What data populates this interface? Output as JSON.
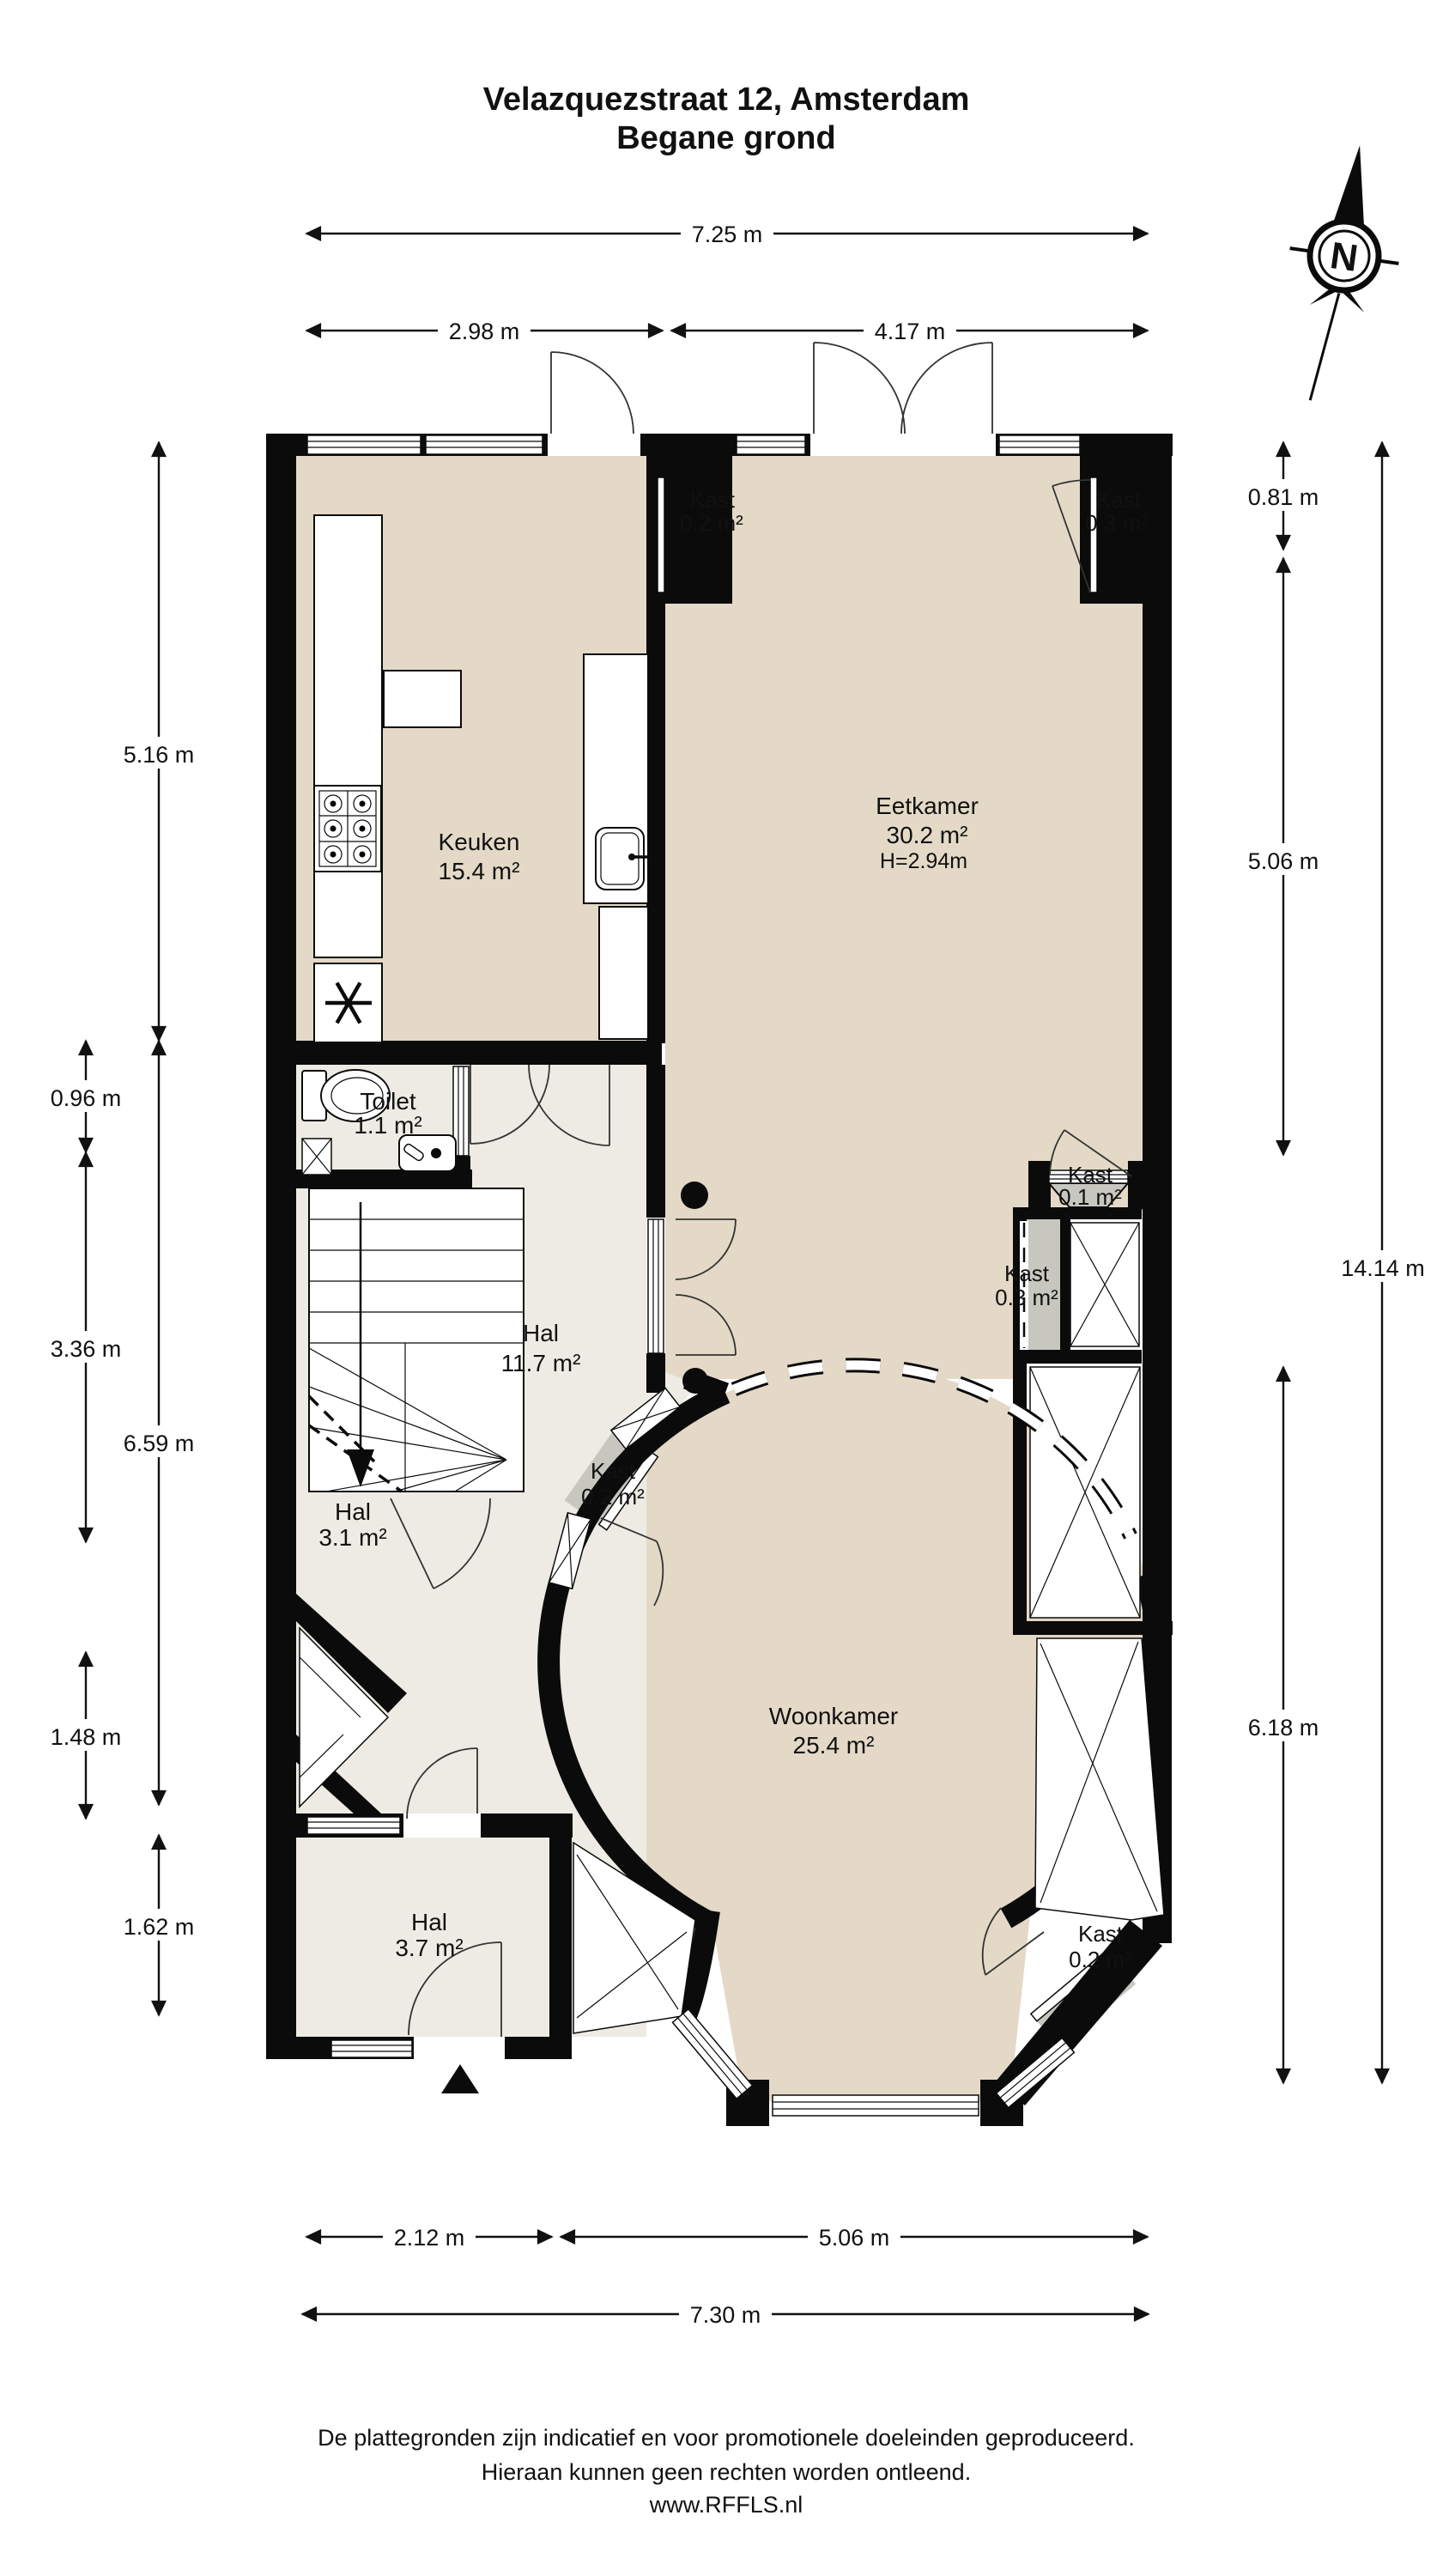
{
  "title": {
    "line1": "Velazquezstraat 12, Amsterdam",
    "line2": "Begane grond"
  },
  "compass": {
    "label": "N"
  },
  "labels": {
    "keuken": {
      "name": "Keuken",
      "area": "15.4 m²"
    },
    "eetkamer": {
      "name": "Eetkamer",
      "area": "30.2 m²",
      "height": "H=2.94m"
    },
    "woonkamer": {
      "name": "Woonkamer",
      "area": "25.4 m²"
    },
    "toilet": {
      "name": "Toilet",
      "area": "1.1 m²"
    },
    "hal_groot": {
      "name": "Hal",
      "area": "11.7 m²"
    },
    "hal_midden": {
      "name": "Hal",
      "area": "3.1 m²"
    },
    "hal_entree": {
      "name": "Hal",
      "area": "3.7 m²"
    },
    "kast_keuken": {
      "name": "Kast",
      "area": "0.2 m²"
    },
    "kast_eetkamer": {
      "name": "Kast",
      "area": "0.3 m²"
    },
    "kast_klein": {
      "name": "Kast",
      "area": "0.1 m²"
    },
    "kast_rechts": {
      "name": "Kast",
      "area": "0.3 m²"
    },
    "kast_rond": {
      "name": "Kast",
      "area": "0.2 m²"
    },
    "kast_erker": {
      "name": "Kast",
      "area": "0.2 m²"
    }
  },
  "dimensions": {
    "top_total": "7.25 m",
    "top_left": "2.98 m",
    "top_right": "4.17 m",
    "left_outer_upper": "5.16 m",
    "left_outer_lower": "6.59 m",
    "left_inner_1": "0.96 m",
    "left_inner_2": "3.36 m",
    "left_inner_3": "1.48 m",
    "left_inner_4": "1.62 m",
    "right_inner_1": "0.81 m",
    "right_inner_2": "5.06 m",
    "right_inner_3": "6.18 m",
    "right_outer": "14.14 m",
    "bottom_left": "2.12 m",
    "bottom_right": "5.06 m",
    "bottom_total": "7.30 m"
  },
  "footer": {
    "line1": "De plattegronden zijn indicatief en voor promotionele doeleinden geproduceerd.",
    "line2": "Hieraan kunnen geen rechten worden ontleend.",
    "line3": "www.RFFLS.nl"
  },
  "colors": {
    "room_beige": "#e3d9c6",
    "hall_light": "#edebe3",
    "closet_gray": "#c7c7c0",
    "wall_black": "#0b0b0b"
  }
}
